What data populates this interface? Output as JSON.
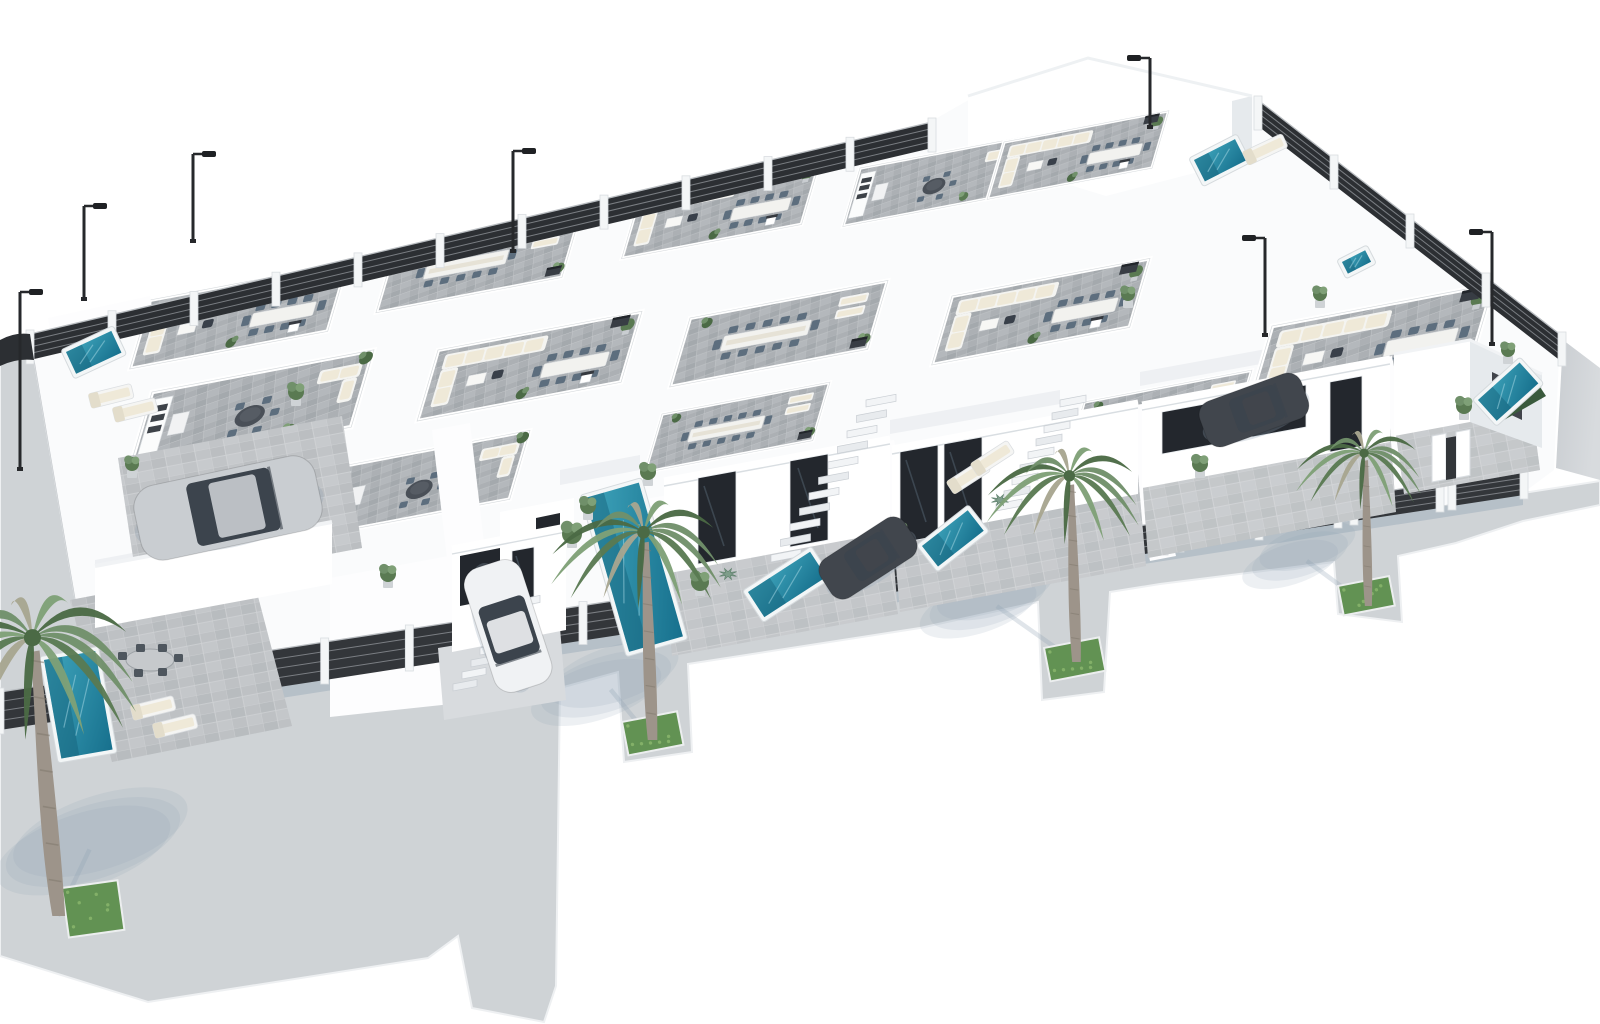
{
  "meta": {
    "image_type": "3d-architectural-render",
    "subject": "aerial isometric render of a white villa residential development with rooftop terraces, private pools, palm trees, dark slat fences and street lamps",
    "visible_text": "none"
  },
  "colors": {
    "background": "#ffffff",
    "block": "#fafbfc",
    "pavement": "#cfd3d6",
    "pavement_edge": "#eef0f2",
    "patio": "#c6cacd",
    "tile": "#acb0b4",
    "wall": "#ffffff",
    "wall_shade": "#e6eaed",
    "wall_deep": "#d6dbdf",
    "fence": "#33363a",
    "fence_back": "#2c2f33",
    "fence_line": "#8d9196",
    "pool_hi": "#39a0b8",
    "pool_lo": "#17708d",
    "pool_deep": "#155f78",
    "pool_rim": "#f3f6f7",
    "glass": "#23272d",
    "glass_hi": "#5c6d7c",
    "green1": "#70906a",
    "green2": "#5a7a52",
    "green3": "#7fa077",
    "green4": "#4b6a45",
    "frond_dry": "#a8a690",
    "agave": "#7e9d8a",
    "trunk": "#9d948a",
    "trunk_ring": "#80786d",
    "grass": "#629253",
    "grass_hi": "#83b068",
    "shadow": "#8fa0b4",
    "cream": "#efe9d8",
    "furn_white": "#f4f4f1",
    "chair_slate": "#5d6e7e",
    "box_dark": "#383d44",
    "car_silver": "#c9cdd1",
    "car_white": "#f0f2f4",
    "car_dark": "#41464d",
    "car_glass": "#3c444d",
    "lamp": "#26282b"
  },
  "scene": {
    "counts": {
      "street_palms": 4,
      "street_lamps": 7,
      "pools": 8,
      "cars": 4,
      "rooftop_terraces": 13,
      "fence_segments": 11,
      "staircases": 3
    },
    "palms": [
      {
        "x": 58,
        "y": 916,
        "s": 1.42,
        "lean": -16,
        "sdx": 35,
        "sdy": -74
      },
      {
        "x": 652,
        "y": 740,
        "s": 1.06,
        "lean": -6,
        "sdx": -46,
        "sdy": -56
      },
      {
        "x": 1076,
        "y": 662,
        "s": 0.95,
        "lean": -5,
        "sdx": -88,
        "sdy": -62
      },
      {
        "x": 1368,
        "y": 606,
        "s": 0.78,
        "lean": -3,
        "sdx": -68,
        "sdy": -50
      }
    ],
    "grass": [
      {
        "x": 62,
        "y": 888,
        "w": 56,
        "h": 50,
        "rot": -8
      },
      {
        "x": 622,
        "y": 722,
        "w": 56,
        "h": 34,
        "rot": -11
      },
      {
        "x": 1044,
        "y": 648,
        "w": 56,
        "h": 34,
        "rot": -11
      },
      {
        "x": 1338,
        "y": 586,
        "w": 52,
        "h": 30,
        "rot": -11
      }
    ],
    "lamps": [
      {
        "x": 20,
        "y": 470,
        "h": 178,
        "dir": 1
      },
      {
        "x": 84,
        "y": 300,
        "h": 94,
        "dir": 1
      },
      {
        "x": 193,
        "y": 242,
        "h": 88,
        "dir": 1
      },
      {
        "x": 513,
        "y": 252,
        "h": 101,
        "dir": 1
      },
      {
        "x": 1150,
        "y": 128,
        "h": 70,
        "dir": -1
      },
      {
        "x": 1265,
        "y": 336,
        "h": 98,
        "dir": -1
      },
      {
        "x": 1492,
        "y": 345,
        "h": 113,
        "dir": -1
      }
    ],
    "pools": [
      {
        "x": 44,
        "y": 660,
        "w": 52,
        "h": 100,
        "rot": -10
      },
      {
        "x": 585,
        "y": 498,
        "w": 56,
        "h": 160,
        "rot": -16
      },
      {
        "x": 748,
        "y": 592,
        "w": 74,
        "h": 30,
        "rot": -33
      },
      {
        "x": 922,
        "y": 546,
        "w": 58,
        "h": 26,
        "rot": -38
      },
      {
        "x": 1478,
        "y": 400,
        "w": 56,
        "h": 28,
        "rot": -42
      },
      {
        "x": 1194,
        "y": 160,
        "w": 46,
        "h": 24,
        "rot": -27
      },
      {
        "x": 66,
        "y": 352,
        "w": 50,
        "h": 24,
        "rot": -25
      },
      {
        "x": 1342,
        "y": 262,
        "w": 26,
        "h": 13,
        "rot": -27
      }
    ],
    "cars": [
      {
        "x": 228,
        "y": 508,
        "rot": -12,
        "l": 185,
        "w": 76,
        "color": "car_silver",
        "name": "car-silver-suv"
      },
      {
        "x": 508,
        "y": 626,
        "rot": 72,
        "l": 130,
        "w": 60,
        "color": "car_white",
        "name": "car-white-hatchback"
      },
      {
        "x": 868,
        "y": 558,
        "rot": -33,
        "l": 100,
        "w": 46,
        "color": "car_dark",
        "name": "car-dark-1"
      },
      {
        "x": 1254,
        "y": 410,
        "rot": -20,
        "l": 108,
        "w": 48,
        "color": "car_dark",
        "name": "car-dark-2"
      }
    ],
    "terraces": [
      {
        "v": 1,
        "x": 150,
        "y": 300,
        "s": 0.66
      },
      {
        "v": 3,
        "x": 395,
        "y": 248,
        "s": 0.62
      },
      {
        "v": 1,
        "x": 640,
        "y": 196,
        "s": 0.6
      },
      {
        "v": 2,
        "x": 860,
        "y": 168,
        "s": 0.56
      },
      {
        "v": 1,
        "x": 1004,
        "y": 142,
        "s": 0.55
      },
      {
        "v": 2,
        "x": 152,
        "y": 392,
        "s": 0.74
      },
      {
        "v": 1,
        "x": 438,
        "y": 350,
        "s": 0.68
      },
      {
        "v": 3,
        "x": 690,
        "y": 318,
        "s": 0.66
      },
      {
        "v": 1,
        "x": 952,
        "y": 296,
        "s": 0.66
      },
      {
        "v": 1,
        "x": 1272,
        "y": 326,
        "s": 0.74
      },
      {
        "v": 2,
        "x": 332,
        "y": 468,
        "s": 0.66
      },
      {
        "v": 3,
        "x": 662,
        "y": 414,
        "s": 0.56
      },
      {
        "v": 3,
        "x": 1084,
        "y": 402,
        "s": 0.56
      }
    ],
    "fences": [
      {
        "x1": 30,
        "y1": 360,
        "x2": 932,
        "y2": 148,
        "h": 26,
        "back": true
      },
      {
        "x1": 1258,
        "y1": 126,
        "x2": 1562,
        "y2": 362,
        "h": 26,
        "back": true
      },
      {
        "x1": 0,
        "y1": 730,
        "x2": 240,
        "y2": 693,
        "h": 38
      },
      {
        "x1": 240,
        "y1": 693,
        "x2": 494,
        "y2": 654,
        "h": 38
      },
      {
        "x1": 514,
        "y1": 651,
        "x2": 652,
        "y2": 630,
        "h": 35
      },
      {
        "x1": 668,
        "y1": 627,
        "x2": 832,
        "y2": 602,
        "h": 33
      },
      {
        "x1": 848,
        "y1": 599,
        "x2": 1038,
        "y2": 570,
        "h": 31
      },
      {
        "x1": 1054,
        "y1": 568,
        "x2": 1164,
        "y2": 551,
        "h": 29
      },
      {
        "x1": 1180,
        "y1": 548,
        "x2": 1338,
        "y2": 524,
        "h": 27
      },
      {
        "x1": 1354,
        "y1": 521,
        "x2": 1440,
        "y2": 508,
        "h": 25
      },
      {
        "x1": 1452,
        "y1": 506,
        "x2": 1524,
        "y2": 495,
        "h": 23
      }
    ],
    "stairs": [
      {
        "x": 866,
        "y": 400,
        "n": 11,
        "dx": -9.5,
        "dy": 15.5,
        "w": 30
      },
      {
        "x": 1060,
        "y": 400,
        "n": 9,
        "dx": -8,
        "dy": 13,
        "w": 26
      },
      {
        "x": 516,
        "y": 600,
        "n": 8,
        "dx": -9,
        "dy": 12,
        "w": 24
      }
    ],
    "plants": [
      {
        "x": 388,
        "y": 580,
        "r": 8
      },
      {
        "x": 572,
        "y": 540,
        "r": 10
      },
      {
        "x": 588,
        "y": 512,
        "r": 8
      },
      {
        "x": 700,
        "y": 588,
        "r": 9
      },
      {
        "x": 728,
        "y": 574,
        "r": 8,
        "agave": true
      },
      {
        "x": 860,
        "y": 552,
        "r": 8,
        "agave": true
      },
      {
        "x": 900,
        "y": 536,
        "r": 7
      },
      {
        "x": 1000,
        "y": 500,
        "r": 8,
        "agave": true
      },
      {
        "x": 1200,
        "y": 470,
        "r": 8
      },
      {
        "x": 1464,
        "y": 412,
        "r": 8
      },
      {
        "x": 1508,
        "y": 356,
        "r": 7
      },
      {
        "x": 648,
        "y": 478,
        "r": 8
      },
      {
        "x": 296,
        "y": 398,
        "r": 8
      },
      {
        "x": 132,
        "y": 470,
        "r": 7
      },
      {
        "x": 1320,
        "y": 300,
        "r": 7
      },
      {
        "x": 1128,
        "y": 300,
        "r": 7
      }
    ],
    "loungers": [
      {
        "x": 130,
        "y": 706,
        "rot": -14
      },
      {
        "x": 152,
        "y": 724,
        "rot": -14
      },
      {
        "x": 946,
        "y": 482,
        "rot": -33
      },
      {
        "x": 970,
        "y": 464,
        "rot": -33
      },
      {
        "x": 88,
        "y": 394,
        "rot": -14
      },
      {
        "x": 112,
        "y": 408,
        "rot": -14
      },
      {
        "x": 1242,
        "y": 152,
        "rot": -25
      }
    ]
  }
}
